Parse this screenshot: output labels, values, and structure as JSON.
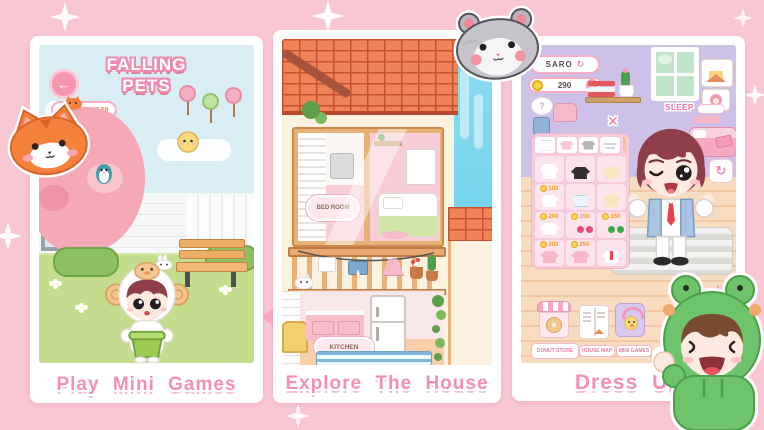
{
  "colors": {
    "background": "#f9c6d3",
    "card": "#ffffff",
    "caption_pink": "#f58fb4",
    "sky_blue": "#d9edf4",
    "grass_green": "#c3dc8e",
    "roof_orange": "#ef8257",
    "wall_lavender": "#cdc1e8",
    "wall_peach": "#f8dcc2",
    "coin_yellow": "#ffd34d",
    "price_orange": "#f59a2e"
  },
  "cards": [
    {
      "caption": "Play Mini Games"
    },
    {
      "caption": "Explore The House"
    },
    {
      "caption": "Dress Up"
    }
  ],
  "mini_game": {
    "title_line1": "FALLING",
    "title_line2": "PETS",
    "points_label": "POINTS: 1539",
    "back_icon": "←"
  },
  "house": {
    "bedroom_sign": "BED ROOM",
    "kitchen_sign": "KITCHEN"
  },
  "dressup": {
    "player_name": "SARO",
    "coin_balance": "290",
    "add_icon": "+",
    "shuffle_icon": "↻",
    "close_icon": "✕",
    "refresh_icon": "↻",
    "sleep_label": "SLEEP",
    "thought_bubble": "?",
    "wardrobe": {
      "items": [
        {
          "name": "white sweater",
          "price": ""
        },
        {
          "name": "black top",
          "price": ""
        },
        {
          "name": "cream top",
          "price": ""
        },
        {
          "name": "white ruffle top",
          "price": "100"
        },
        {
          "name": "white tee",
          "price": ""
        },
        {
          "name": "yellow top",
          "price": ""
        },
        {
          "name": "white vneck top",
          "price": "200"
        },
        {
          "name": "cherry top",
          "price": "150"
        },
        {
          "name": "green top",
          "price": "150"
        },
        {
          "name": "pink ruffle top",
          "price": "300"
        },
        {
          "name": "pink top",
          "price": "250"
        },
        {
          "name": "white shirt with red tie",
          "price": ""
        }
      ]
    },
    "menu": [
      {
        "label": "DONUT STORE"
      },
      {
        "label": "HOUSE MAP"
      },
      {
        "label": "MINI GAMES"
      }
    ]
  },
  "stickers": [
    {
      "name": "orange cat"
    },
    {
      "name": "gray hamster"
    },
    {
      "name": "frog hoodie kid"
    }
  ]
}
